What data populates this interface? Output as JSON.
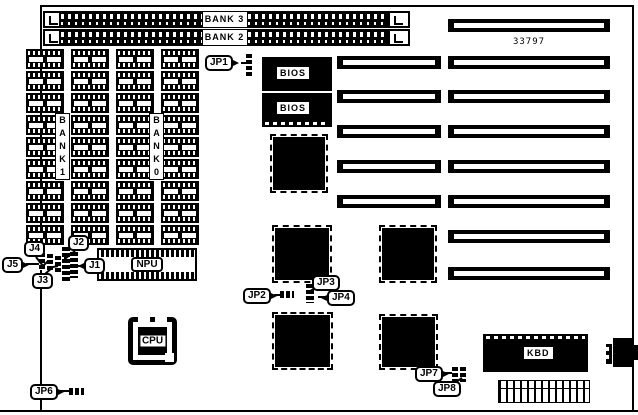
{
  "diagram": {
    "part_number": "33797",
    "simm_slots": [
      {
        "label": "BANK 3"
      },
      {
        "label": "BANK 2"
      }
    ],
    "memory_array": {
      "rows": 9,
      "cols": 4,
      "chip_count": 36,
      "bank_labels": [
        {
          "text": "B\nA\nN\nK\n1"
        },
        {
          "text": "B\nA\nN\nK\n0"
        }
      ]
    },
    "chips": {
      "bios_top": {
        "label": "BIOS"
      },
      "bios_bottom": {
        "label": "BIOS"
      },
      "npu": {
        "label": "NPU"
      },
      "cpu": {
        "label": "CPU"
      },
      "kbd": {
        "label": "KBD"
      }
    },
    "expansion_slots": {
      "top_single": 1,
      "pairs": 5,
      "long_only": 2
    },
    "qfp_chip_count": 5,
    "callouts": {
      "jp1": {
        "label": "JP1"
      },
      "jp2": {
        "label": "JP2"
      },
      "jp3": {
        "label": "JP3"
      },
      "jp4": {
        "label": "JP4"
      },
      "jp6": {
        "label": "JP6"
      },
      "jp7": {
        "label": "JP7"
      },
      "jp8": {
        "label": "JP8"
      },
      "j1": {
        "label": "J1"
      },
      "j2": {
        "label": "J2"
      },
      "j3": {
        "label": "J3"
      },
      "j4": {
        "label": "J4"
      },
      "j5": {
        "label": "J5"
      }
    },
    "colors": {
      "ink": "#000000",
      "background": "#ffffff"
    }
  }
}
